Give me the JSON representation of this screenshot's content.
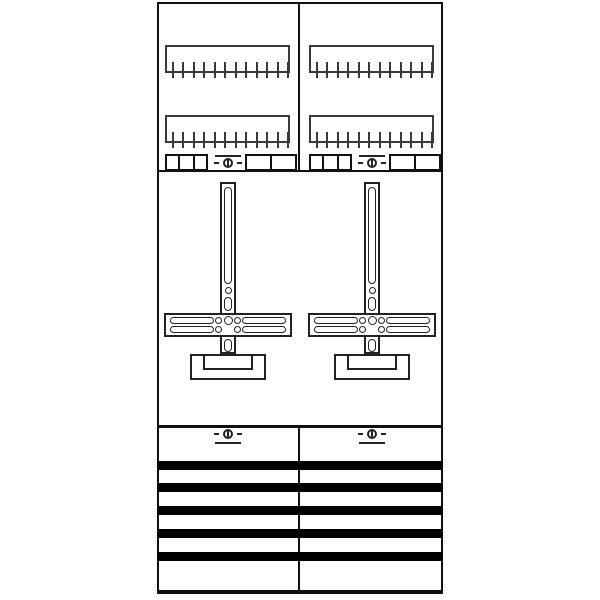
{
  "window": {
    "width": 600,
    "height": 600,
    "background": "#ffffff"
  },
  "diagram": {
    "kind": "two-field-meter-panel-technical-drawing",
    "colors": {
      "background": "#ffffff",
      "panel_border": "#101010",
      "line": "#222222",
      "comb": "#3a3a3a",
      "busbar": "#000000"
    },
    "panel": {
      "x": 157,
      "y": 2,
      "width": 286,
      "height": 592,
      "border_width": 2,
      "bottom_border_width": 4
    },
    "center_divider": {
      "x": 298,
      "width": 2,
      "top_segment": {
        "y": 2,
        "height": 168
      },
      "bottom_segment": {
        "y": 426,
        "height": 168
      }
    },
    "section_lines": [
      {
        "y": 170,
        "height": 2
      },
      {
        "y": 425,
        "height": 3
      }
    ],
    "column_centers": [
      228,
      372
    ],
    "comb_rails": {
      "ys": [
        45,
        115
      ],
      "width": 125,
      "height": 28,
      "border_width": 2,
      "tick_count": 12,
      "tick_width": 2,
      "tick_height": 16,
      "tick_top_offset": 17,
      "tick_inset": 7,
      "tick_spacing": 10.45
    },
    "terminal_row": {
      "y": 154,
      "height": 17,
      "left_block": {
        "offset": -63,
        "width": 43,
        "cells": 3
      },
      "right_block": {
        "offset": 17,
        "width": 52,
        "cells": 2
      }
    },
    "seal_screw_top": {
      "circle_center_y": 163,
      "line_y": 155,
      "line_width": 26,
      "line_position": "above"
    },
    "seal_screw_bottom": {
      "circle_center_y": 434,
      "line_y": 442,
      "line_width": 26,
      "line_position": "below"
    },
    "cross": {
      "vbar": {
        "half_width": 8,
        "top": 182,
        "bottom": 354,
        "border": 2
      },
      "slot_width": 8,
      "long_slot": {
        "top": 187,
        "bottom": 284
      },
      "hole": {
        "center_y": 290,
        "diameter": 7
      },
      "short_slot_top": {
        "top": 297,
        "bottom": 311
      },
      "short_slot_bottom": {
        "top": 339,
        "bottom": 352
      },
      "crossbar": {
        "half_width": 64,
        "top": 313,
        "height": 24,
        "border": 2
      },
      "bar_slots": {
        "upper_top": 317,
        "lower_top": 326,
        "height": 7,
        "outer_inset": 6,
        "length": 44,
        "inner_circle_d": 7,
        "center_circle_d": 9
      },
      "base": {
        "top": 354,
        "outer_half_width": 38,
        "outer_height": 26,
        "inner_half_width": 25,
        "inner_height": 16
      }
    },
    "busbars": {
      "x": 157,
      "width": 286,
      "height": 9,
      "ys": [
        461,
        483,
        506,
        529,
        552
      ]
    }
  }
}
